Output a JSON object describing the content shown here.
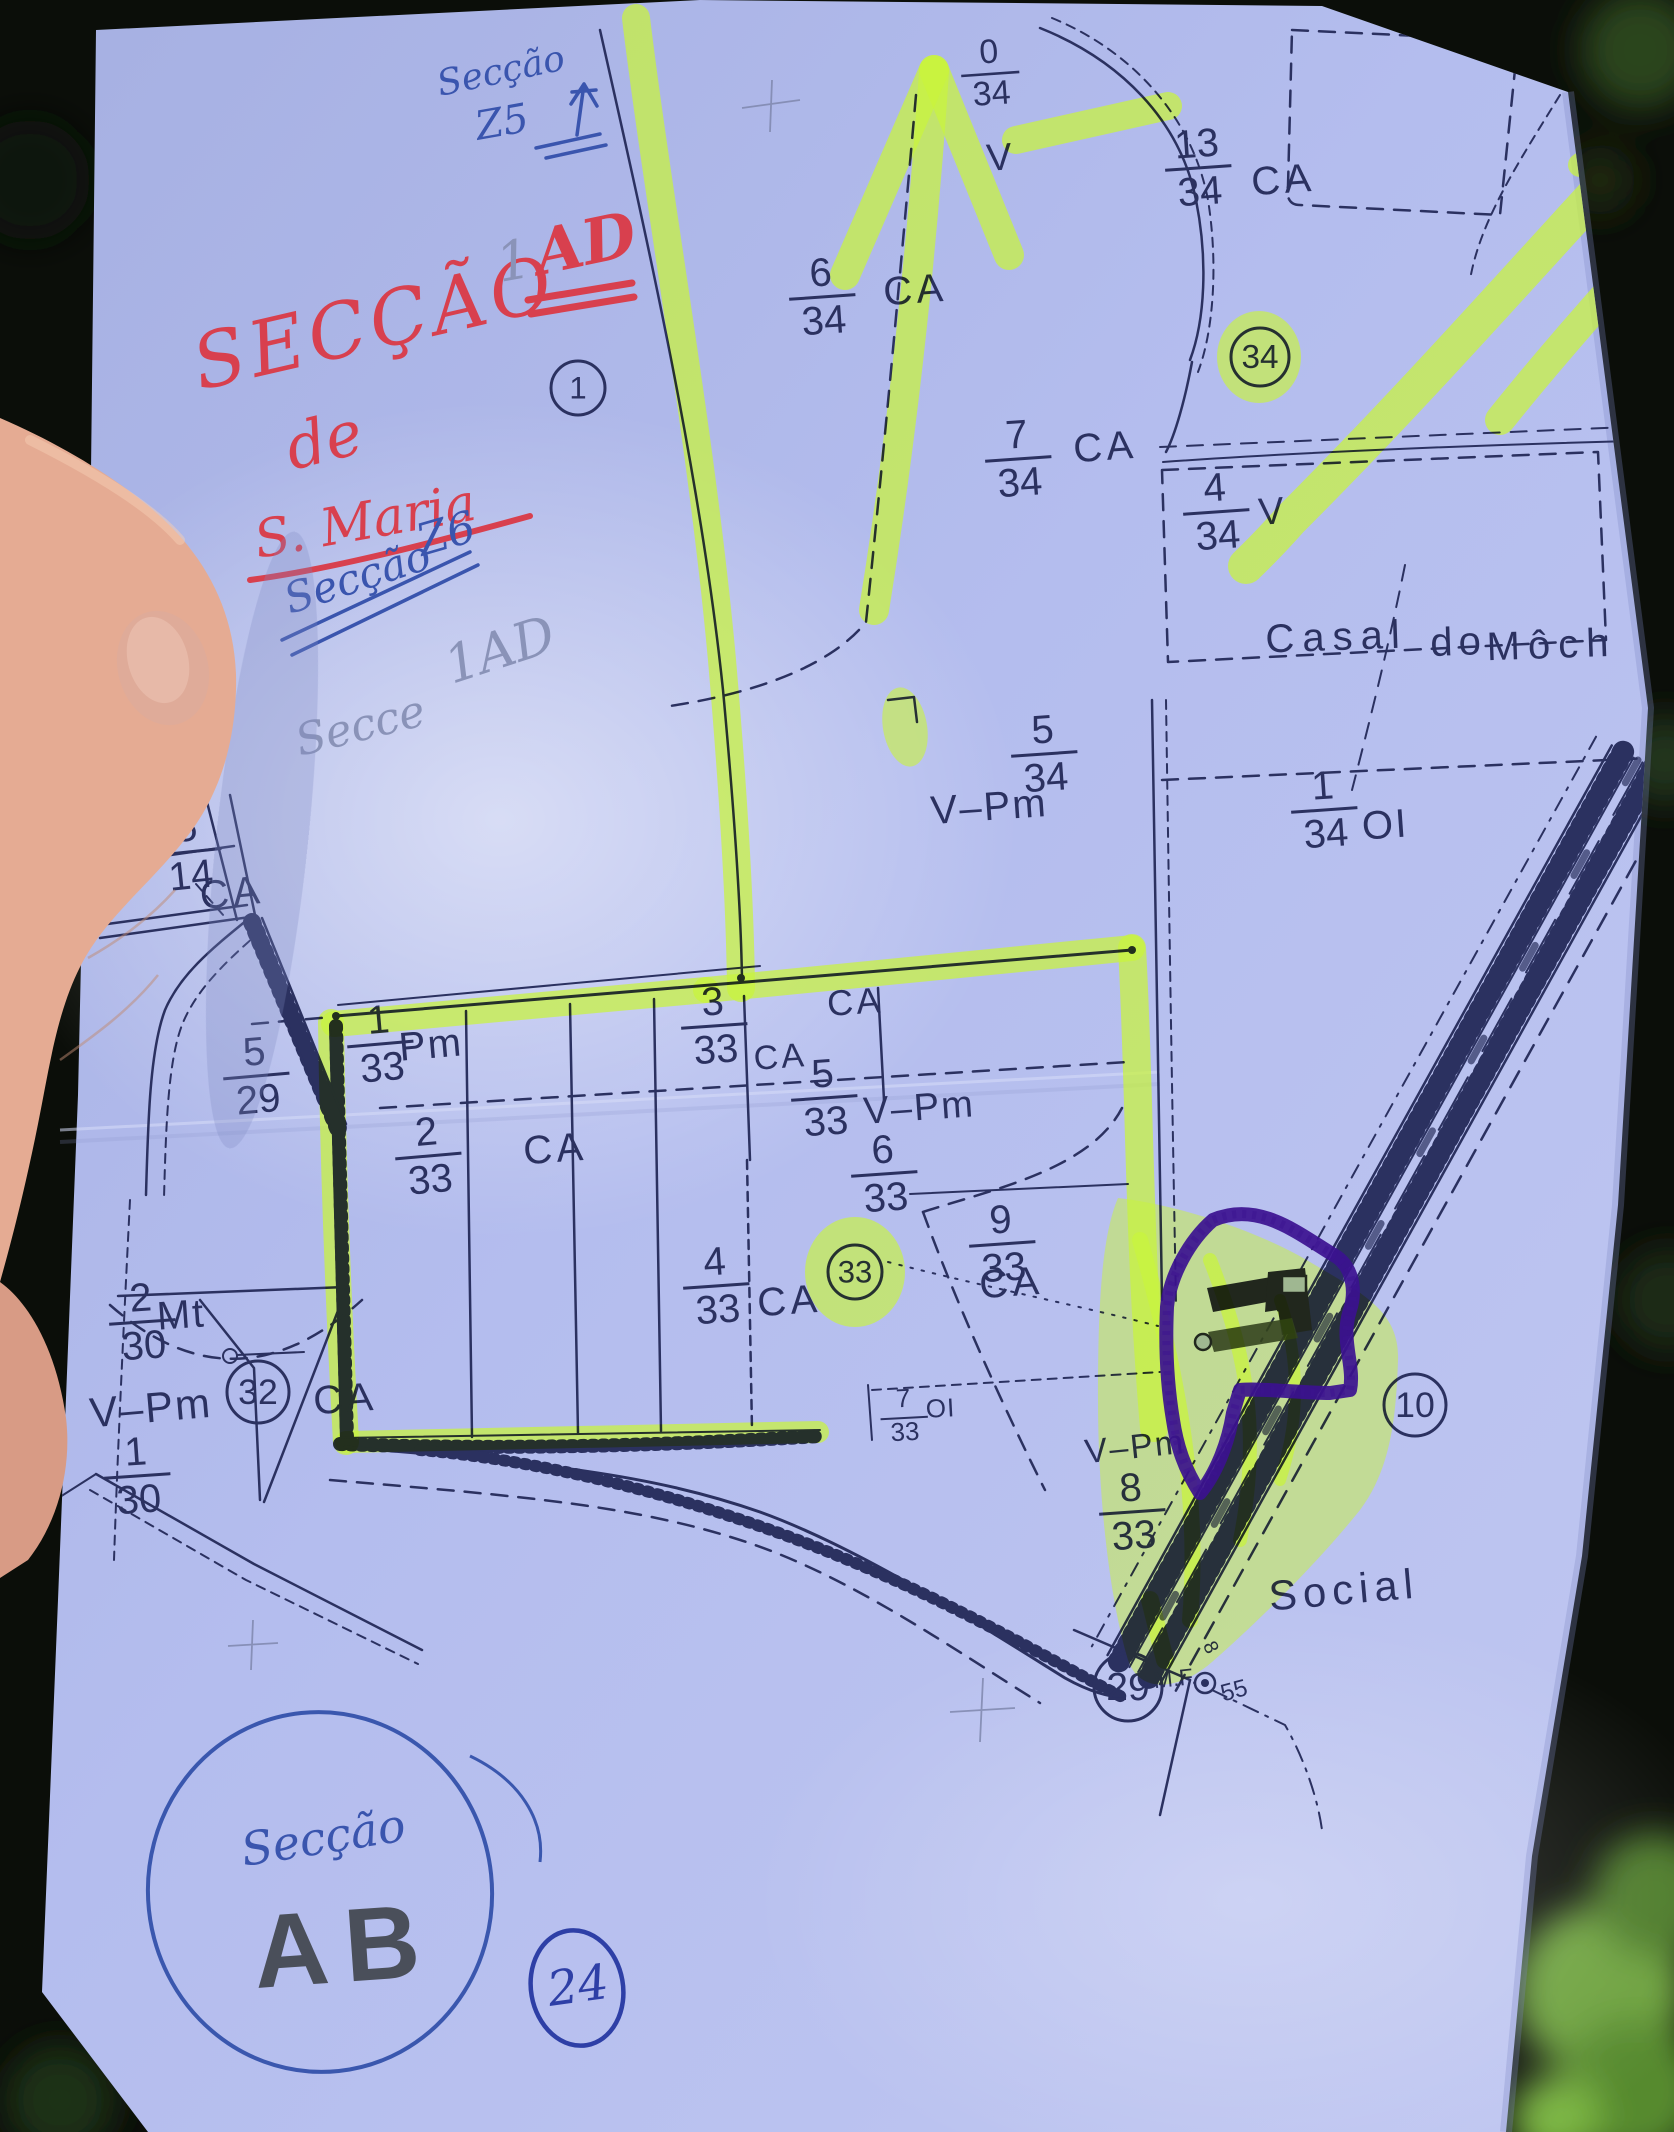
{
  "photo": {
    "background": "#0b0e09",
    "paper_color": "#b2bcec",
    "ink_color": "#2b3160",
    "highlight_color": "#c9f43c",
    "marker_purple": "#3b1190",
    "pen_red": "#d8404e",
    "pen_blue": "#3a55ae",
    "pencil": "#8a93b8"
  },
  "annotations": {
    "red_title_word": "SECÇÃO",
    "red_title_code": "AD",
    "red_title_de": "de",
    "red_title_saint": "S. Maria",
    "pencil_one": "1",
    "blue_top_label": "Secção",
    "blue_top_code": "Z5",
    "blue_mid_label": "Secção",
    "blue_mid_code": "Z6",
    "pencil_note_label": "Secce",
    "pencil_note_code": "1AD",
    "bottom_circle_label": "Secção",
    "bottom_circle_code": "AB",
    "bottom_circled_number": "24"
  },
  "map": {
    "place_names": {
      "casal": "Casal",
      "do": "do",
      "mocho": "Môch",
      "social": "Social"
    },
    "junction": {
      "mf": "M.F.",
      "diameter": "55"
    },
    "fractions": [
      {
        "num": "0",
        "den": "34",
        "x": 990,
        "y": 70,
        "s": 34,
        "rot": -4
      },
      {
        "num": "6",
        "den": "34",
        "x": 822,
        "y": 293,
        "s": 40,
        "rot": -4
      },
      {
        "num": "13",
        "den": "34",
        "x": 1198,
        "y": 164,
        "s": 40,
        "rot": -4
      },
      {
        "num": "7",
        "den": "34",
        "x": 1018,
        "y": 455,
        "s": 40,
        "rot": -4
      },
      {
        "num": "4",
        "den": "34",
        "x": 1216,
        "y": 508,
        "s": 40,
        "rot": -4
      },
      {
        "num": "5",
        "den": "34",
        "x": 1044,
        "y": 750,
        "s": 40,
        "rot": -4
      },
      {
        "num": "1",
        "den": "34",
        "x": 1324,
        "y": 806,
        "s": 40,
        "rot": -4
      },
      {
        "num": "5",
        "den": "14",
        "x": 188,
        "y": 848,
        "s": 40,
        "rot": -6
      },
      {
        "num": "5",
        "den": "29",
        "x": 256,
        "y": 1072,
        "s": 40,
        "rot": -5
      },
      {
        "num": "1",
        "den": "33",
        "x": 380,
        "y": 1040,
        "s": 40,
        "rot": -5
      },
      {
        "num": "2",
        "den": "33",
        "x": 428,
        "y": 1152,
        "s": 40,
        "rot": -5
      },
      {
        "num": "3",
        "den": "33",
        "x": 714,
        "y": 1022,
        "s": 40,
        "rot": -4
      },
      {
        "num": "5",
        "den": "33",
        "x": 824,
        "y": 1094,
        "s": 40,
        "rot": -4
      },
      {
        "num": "6",
        "den": "33",
        "x": 884,
        "y": 1170,
        "s": 40,
        "rot": -4
      },
      {
        "num": "9",
        "den": "33",
        "x": 1002,
        "y": 1240,
        "s": 40,
        "rot": -4
      },
      {
        "num": "4",
        "den": "33",
        "x": 716,
        "y": 1282,
        "s": 40,
        "rot": -4
      },
      {
        "num": "2",
        "den": "30",
        "x": 142,
        "y": 1318,
        "s": 40,
        "rot": -4
      },
      {
        "num": "1",
        "den": "30",
        "x": 137,
        "y": 1472,
        "s": 40,
        "rot": -4
      },
      {
        "num": "8",
        "den": "33",
        "x": 1132,
        "y": 1508,
        "s": 40,
        "rot": -4
      },
      {
        "num": "7",
        "den": "33",
        "x": 904,
        "y": 1414,
        "s": 26,
        "rot": -3
      }
    ],
    "texts": [
      {
        "t": "CA",
        "x": 916,
        "y": 303,
        "s": 40,
        "rot": -4,
        "sp": 4
      },
      {
        "t": "CA",
        "x": 1106,
        "y": 460,
        "s": 40,
        "rot": -4,
        "sp": 4
      },
      {
        "t": "CA",
        "x": 1284,
        "y": 193,
        "s": 40,
        "rot": -4,
        "sp": 4
      },
      {
        "t": "CA",
        "x": 233,
        "y": 906,
        "s": 40,
        "rot": -6,
        "sp": 4
      },
      {
        "t": "CA",
        "x": 856,
        "y": 1014,
        "s": 36,
        "rot": -4,
        "sp": 3
      },
      {
        "t": "CA",
        "x": 556,
        "y": 1162,
        "s": 40,
        "rot": -4,
        "sp": 4
      },
      {
        "t": "CA",
        "x": 781,
        "y": 1068,
        "s": 34,
        "rot": -4,
        "sp": 3
      },
      {
        "t": "CA",
        "x": 1012,
        "y": 1296,
        "s": 40,
        "rot": -4,
        "sp": 4
      },
      {
        "t": "CA",
        "x": 790,
        "y": 1314,
        "s": 40,
        "rot": -4,
        "sp": 4
      },
      {
        "t": "CA",
        "x": 346,
        "y": 1412,
        "s": 40,
        "rot": -4,
        "sp": 4
      },
      {
        "t": "V",
        "x": 1000,
        "y": 170,
        "s": 38,
        "rot": -4,
        "sp": 0
      },
      {
        "t": "V",
        "x": 1272,
        "y": 524,
        "s": 38,
        "rot": -4,
        "sp": 0
      },
      {
        "t": "V–Pm",
        "x": 990,
        "y": 820,
        "s": 40,
        "rot": -4,
        "sp": 2
      },
      {
        "t": "V–Pm",
        "x": 920,
        "y": 1120,
        "s": 38,
        "rot": -4,
        "sp": 2
      },
      {
        "t": "V–Pm",
        "x": 152,
        "y": 1422,
        "s": 42,
        "rot": -5,
        "sp": 2
      },
      {
        "t": "V–Pm",
        "x": 1136,
        "y": 1458,
        "s": 34,
        "rot": -6,
        "sp": 2
      },
      {
        "t": "Pm",
        "x": 432,
        "y": 1058,
        "s": 40,
        "rot": -5,
        "sp": 2
      },
      {
        "t": "Mt",
        "x": 182,
        "y": 1328,
        "s": 40,
        "rot": -4,
        "sp": 2
      },
      {
        "t": "OI",
        "x": 1386,
        "y": 838,
        "s": 40,
        "rot": -4,
        "sp": 2
      },
      {
        "t": "OI",
        "x": 941,
        "y": 1417,
        "s": 26,
        "rot": -3,
        "sp": 1
      },
      {
        "t": "8",
        "x": 1205,
        "y": 1650,
        "s": 20,
        "rot": 65,
        "sp": 0
      }
    ],
    "circles": [
      {
        "v": "1",
        "x": 578,
        "y": 388,
        "r": 27
      },
      {
        "v": "34",
        "x": 1260,
        "y": 357,
        "r": 29,
        "hl": true
      },
      {
        "v": "33",
        "x": 855,
        "y": 1272,
        "r": 27,
        "hl": true
      },
      {
        "v": "32",
        "x": 258,
        "y": 1392,
        "r": 31
      },
      {
        "v": "10",
        "x": 1415,
        "y": 1405,
        "r": 31
      },
      {
        "v": "29",
        "x": 1128,
        "y": 1687,
        "r": 34
      }
    ]
  }
}
